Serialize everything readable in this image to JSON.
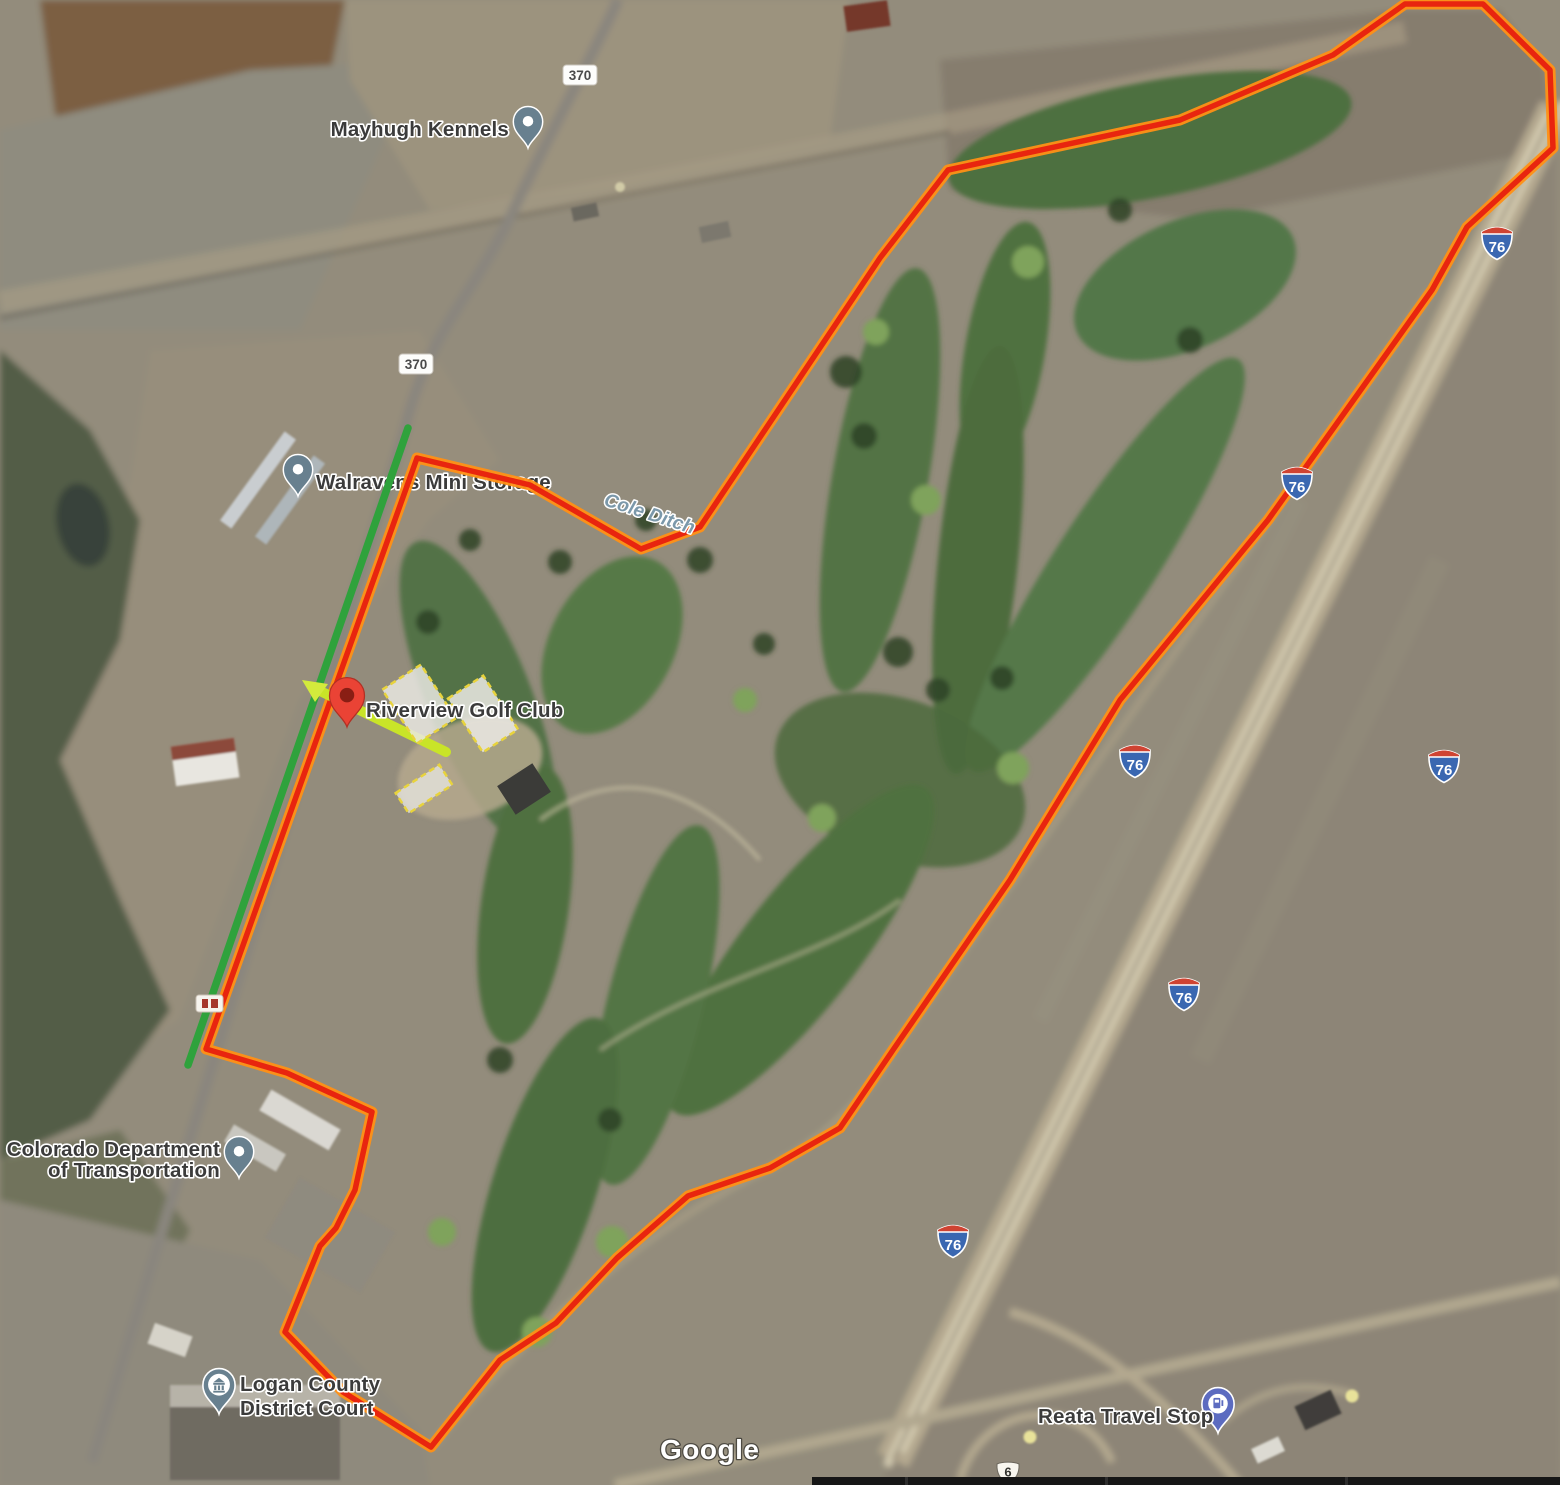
{
  "map": {
    "watermark": "Google",
    "labels": {
      "mayhugh": "Mayhugh Kennels",
      "walravens": "Walravens Mini Storage",
      "cole_ditch": "Cole Ditch",
      "riverview": "Riverview Golf Club",
      "cdot_line1": "Colorado Department",
      "cdot_line2": "of Transportation",
      "logan_line1": "Logan County",
      "logan_line2": "District Court",
      "reata": "Reata Travel Stop"
    },
    "shields": {
      "route_370": "370",
      "interstate_76": "76",
      "us_6": "6"
    },
    "overlay": {
      "boundary_color": "#e8250f",
      "boundary_glow_color": "#ff9015",
      "route_line_color": "#2fa23c",
      "highlight_line_color": "#c9e428",
      "building_outline_color": "#e8d33c",
      "pin_red": "#ea4335",
      "pin_slate": "#68808f",
      "pin_indigo": "#5c6bc0"
    }
  }
}
